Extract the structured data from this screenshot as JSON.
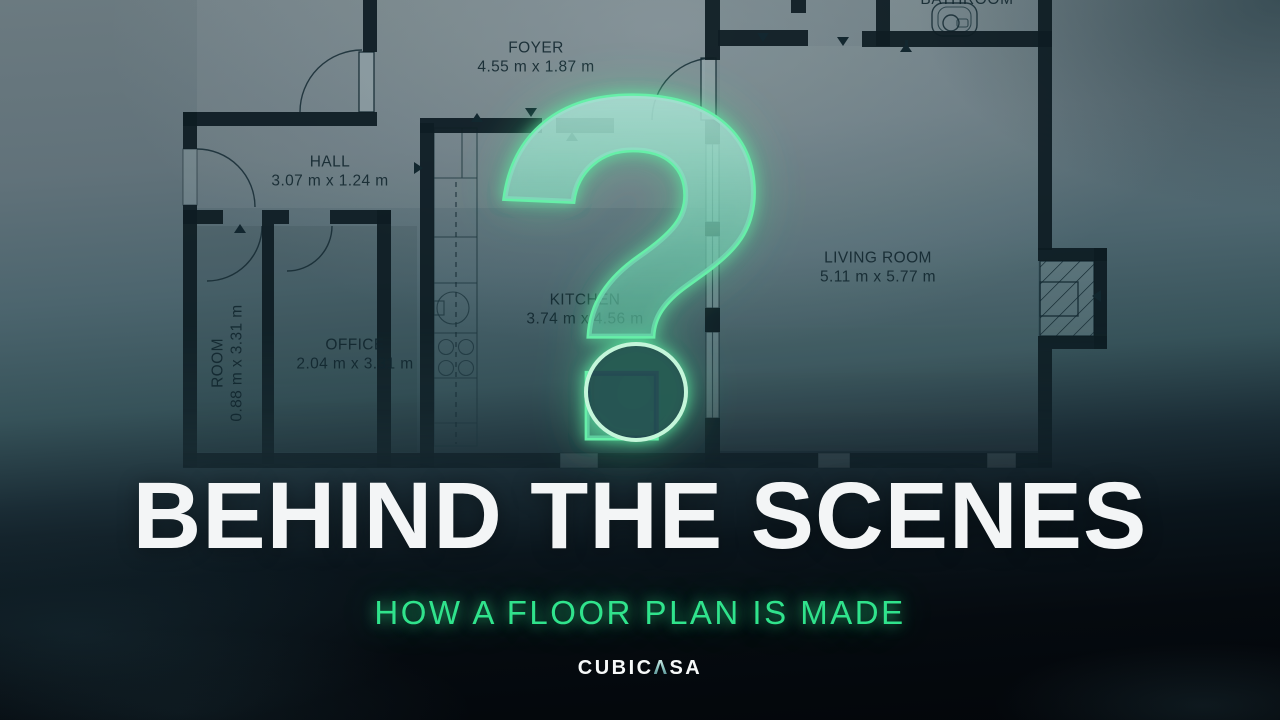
{
  "floor_plan": {
    "rooms": [
      {
        "name": "FOYER",
        "dims": "4.55 m x 1.87 m"
      },
      {
        "name": "HALL",
        "dims": "3.07 m x 1.24 m"
      },
      {
        "name": "BATHROOM",
        "dims": ""
      },
      {
        "name": "KITCHEN",
        "dims": "3.74 m x 4.56 m"
      },
      {
        "name": "LIVING ROOM",
        "dims": "5.11 m x 5.77 m"
      },
      {
        "name": "OFFICE",
        "dims": "2.04 m x 3.31 m"
      },
      {
        "name": "ROOM",
        "dims": "0.88 m x 3.31 m"
      }
    ]
  },
  "overlay": {
    "question_mark": "?"
  },
  "titles": {
    "main": "BEHIND THE SCENES",
    "subtitle": "HOW A FLOOR PLAN IS MADE"
  },
  "logo": {
    "left": "CUBIC",
    "caret": "Λ",
    "right": "SA"
  },
  "colors": {
    "subtitle_green": "#30e38c",
    "glow_green": "#62eda4",
    "title_white": "#f3f5f6",
    "wall_dark": "#0c1b21"
  }
}
